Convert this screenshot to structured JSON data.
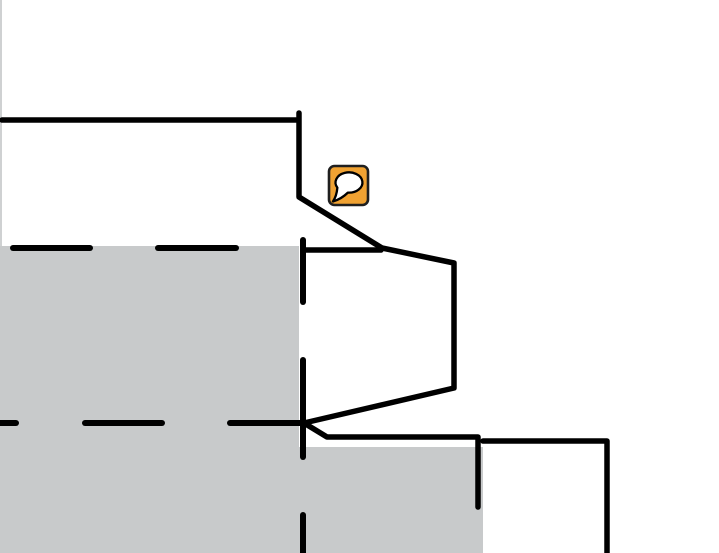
{
  "canvas": {
    "width": 719,
    "height": 553,
    "background": "#ffffff",
    "edge_strip_color": "#cfd1d2"
  },
  "colors": {
    "wall_stroke": "#000000",
    "floor_fill": "#c8cacb",
    "marker_fill": "#f0a232",
    "marker_border": "#1f1f1f",
    "bubble_fill": "#ffffff",
    "bubble_stroke": "#000000"
  },
  "floor_regions": [
    {
      "name": "floor-region-left",
      "x": 0,
      "y": 246,
      "width": 299,
      "height": 307
    },
    {
      "name": "floor-region-bottom",
      "x": 299,
      "y": 447,
      "width": 184,
      "height": 106
    }
  ],
  "walls_solid": [
    {
      "name": "wall-top",
      "points": [
        [
          2,
          120
        ],
        [
          296,
          120
        ]
      ]
    },
    {
      "name": "wall-main-outline",
      "points": [
        [
          299,
          113
        ],
        [
          299,
          197
        ],
        [
          382,
          248
        ],
        [
          454,
          263
        ],
        [
          454,
          388
        ],
        [
          304,
          423
        ],
        [
          327,
          437
        ],
        [
          478,
          437
        ],
        [
          478,
          507
        ]
      ]
    },
    {
      "name": "wall-shelf",
      "points": [
        [
          303,
          250
        ],
        [
          381,
          250
        ]
      ]
    },
    {
      "name": "wall-bottom-right",
      "points": [
        [
          483,
          441
        ],
        [
          607,
          441
        ],
        [
          607,
          553
        ]
      ]
    }
  ],
  "walls_dashed": [
    {
      "name": "dashed-wall-upper-horizontal",
      "segments": [
        [
          [
            13,
            248
          ],
          [
            90,
            248
          ]
        ],
        [
          [
            158,
            248
          ],
          [
            236,
            248
          ]
        ]
      ]
    },
    {
      "name": "dashed-wall-lower-horizontal",
      "segments": [
        [
          [
            0,
            423
          ],
          [
            16,
            423
          ]
        ],
        [
          [
            85,
            423
          ],
          [
            162,
            423
          ]
        ],
        [
          [
            230,
            423
          ],
          [
            301,
            423
          ]
        ]
      ]
    },
    {
      "name": "dashed-wall-vertical",
      "segments": [
        [
          [
            303,
            240
          ],
          [
            303,
            302
          ]
        ],
        [
          [
            303,
            360
          ],
          [
            303,
            457
          ]
        ],
        [
          [
            303,
            515
          ],
          [
            303,
            553
          ]
        ]
      ]
    }
  ],
  "marker": {
    "name": "comment-marker",
    "icon": "speech-bubble-icon",
    "x": 329,
    "y": 166,
    "width": 39,
    "height": 39,
    "radius": 5.5
  }
}
